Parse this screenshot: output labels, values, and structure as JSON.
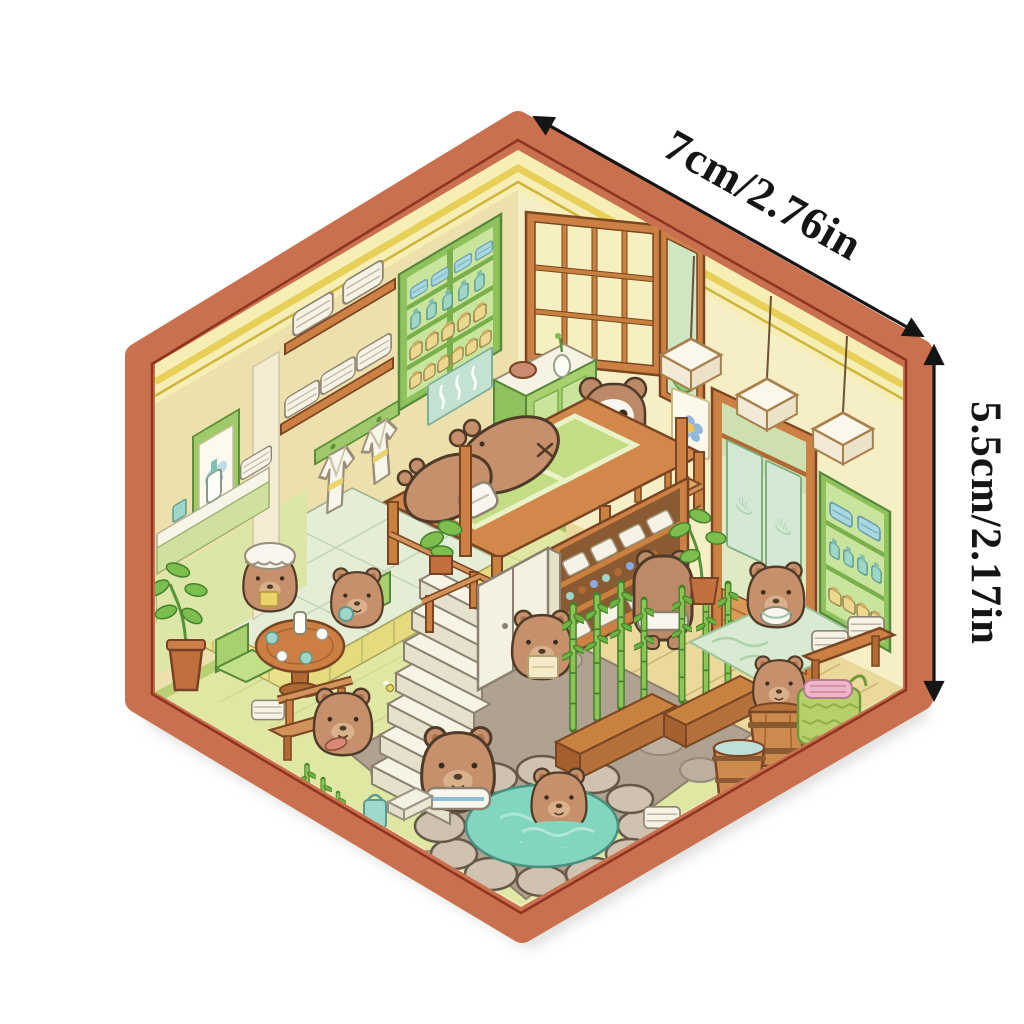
{
  "canvas": {
    "background": "#ffffff"
  },
  "dimension_annotations": {
    "top_edge_label": "7cm/2.76in",
    "right_edge_label": "5.5cm/2.17in",
    "arrow_color": "#151515"
  },
  "sticker": {
    "type": "hexagonal-isometric-capybara-bathhouse-room",
    "onsen_symbol": "♨",
    "counts": {
      "capybaras": 12,
      "hanging_lanterns": 3,
      "noren_curtains": 2,
      "bamboo_planters": 2,
      "wooden_barrels": 2,
      "towel_shelves": 2,
      "hanging_robes": 2
    },
    "palette": {
      "border": "#c9714f",
      "border_inner_line": "#8e3420",
      "left_wall": "#ece0ac",
      "right_wall": "#f6eec5",
      "trim_band": "#f6eeb4",
      "trim_line": "#e6d057",
      "floor_green": "#dfe7a3",
      "floor_wood": "#ead99b",
      "floor_stone": "#b0a290",
      "tatami_platform": "#e4edd6",
      "platform_skirt": "#ebe18a",
      "water": "#82d6c0",
      "wood": "#cd8044",
      "furniture_green": "#8fc25c",
      "capybara": "#c5906b",
      "towel_white": "#f6f3e6"
    },
    "scene_elements": [
      "hanging-scroll",
      "towel-shelf-upper",
      "towel-shelf-lower",
      "robe-rack",
      "wall-supply-cabinet",
      "soap-ledge",
      "lattice-window",
      "sliding-pane",
      "flower-poster",
      "noren-doorway",
      "right-wall-shelf",
      "hanging-lanterns",
      "steam-sign",
      "massage-counter-with-bowl-and-vase",
      "masseuse-capybara",
      "massage-platform-with-two-capybaras",
      "platform-railing",
      "staircase",
      "stair-plant",
      "handrail",
      "tea-platform",
      "tea-table",
      "teapot-and-cups",
      "capybara-with-shower-cap",
      "capybara-with-cup",
      "floor-chairs",
      "potted-plant",
      "bench-with-capybara",
      "lockers",
      "towel-cabinet",
      "capybara-holding-towel",
      "capybara-back-view",
      "bamboo-planters",
      "water-pattern-mat",
      "capybara-with-bowl",
      "door-plant",
      "hot-spring-pool",
      "capybara-in-towel",
      "soaking-capybara",
      "barrel-bath-capybara",
      "empty-barrel",
      "towel-basket",
      "towel-bench",
      "floor-towels",
      "soap-box-and-bag"
    ]
  }
}
